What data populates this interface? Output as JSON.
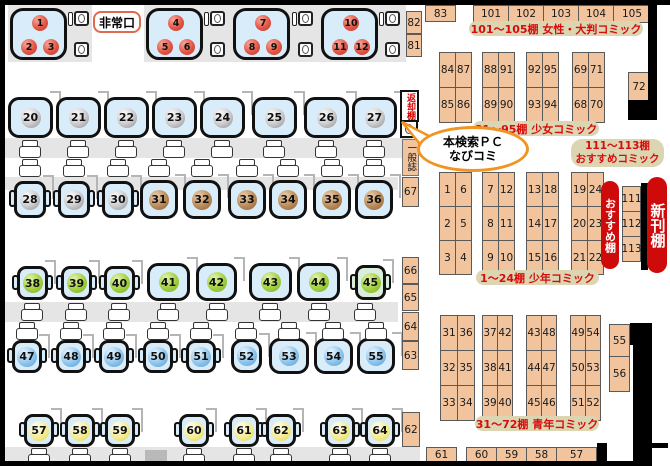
{
  "labels": {
    "exit": "非常口",
    "callout_line1": "本検索ＰＣ",
    "callout_line2": "なびコミ",
    "return_shelf": "返却棚",
    "general_magazines": "一般誌",
    "recommend_shelf": "おすすめ棚",
    "new_arrivals_shelf": "新刊棚"
  },
  "section_labels": {
    "womens": "101～105棚 女性・大判コミック",
    "shojo": "81～95棚 少女コミック",
    "recommend_line1": "111～113棚",
    "recommend_line2": "おすすめコミック",
    "shonen": "1～24棚 少年コミック",
    "seinen": "31～72棚 青年コミック"
  },
  "colors": {
    "room_fill": "#d9ecfa",
    "room45_fill": "#d9eedd",
    "shelf_fill": "#f2c49e",
    "label_text_red": "#d80c0c",
    "label_pill_bg": "#dbd5b2",
    "recommend_pill_bg": "#cf0a0a",
    "exit_border": "#e06a50",
    "callout_border": "#f29422",
    "desk_band": "#e5e5e5",
    "wall": "#000000",
    "seat_red": "#e25545",
    "seat_grey": "#bfbfbf",
    "seat_brown": "#b98a58",
    "seat_green": "#a2cf3f",
    "seat_blue": "#8ec4ec",
    "seat_yellow": "#f3ea8c"
  },
  "map": {
    "group_rooms": [
      {
        "seats": [
          "1",
          "2",
          "3"
        ],
        "x": 10,
        "y": 8
      },
      {
        "seats": [
          "4",
          "5",
          "6"
        ],
        "x": 146,
        "y": 8
      },
      {
        "seats": [
          "7",
          "8",
          "9"
        ],
        "x": 233,
        "y": 8
      },
      {
        "seats": [
          "10",
          "11",
          "12"
        ],
        "x": 321,
        "y": 8
      }
    ],
    "fixtures": [
      [
        68,
        11
      ],
      [
        204,
        11
      ],
      [
        292,
        11
      ],
      [
        379,
        11
      ]
    ],
    "rooms": [
      {
        "n": "20",
        "x": 8,
        "y": 97,
        "w": 45,
        "h": 41,
        "s": "box",
        "c": "grey"
      },
      {
        "n": "21",
        "x": 56,
        "y": 97,
        "w": 45,
        "h": 41,
        "s": "box",
        "c": "grey"
      },
      {
        "n": "22",
        "x": 104,
        "y": 97,
        "w": 45,
        "h": 41,
        "s": "box",
        "c": "grey"
      },
      {
        "n": "23",
        "x": 152,
        "y": 97,
        "w": 45,
        "h": 41,
        "s": "box",
        "c": "grey"
      },
      {
        "n": "24",
        "x": 200,
        "y": 97,
        "w": 45,
        "h": 41,
        "s": "box",
        "c": "grey"
      },
      {
        "n": "25",
        "x": 252,
        "y": 97,
        "w": 45,
        "h": 41,
        "s": "box",
        "c": "grey"
      },
      {
        "n": "26",
        "x": 304,
        "y": 97,
        "w": 45,
        "h": 41,
        "s": "box",
        "c": "grey"
      },
      {
        "n": "27",
        "x": 352,
        "y": 97,
        "w": 45,
        "h": 41,
        "s": "box",
        "c": "grey"
      },
      {
        "n": "28",
        "x": 14,
        "y": 181,
        "w": 32,
        "h": 37,
        "s": "chair",
        "c": "grey"
      },
      {
        "n": "29",
        "x": 58,
        "y": 181,
        "w": 32,
        "h": 37,
        "s": "chair",
        "c": "grey"
      },
      {
        "n": "30",
        "x": 102,
        "y": 181,
        "w": 32,
        "h": 37,
        "s": "chair",
        "c": "grey"
      },
      {
        "n": "31",
        "x": 140,
        "y": 180,
        "w": 38,
        "h": 39,
        "s": "box",
        "c": "brown"
      },
      {
        "n": "32",
        "x": 183,
        "y": 180,
        "w": 38,
        "h": 39,
        "s": "box",
        "c": "brown"
      },
      {
        "n": "33",
        "x": 228,
        "y": 180,
        "w": 38,
        "h": 39,
        "s": "box",
        "c": "brown"
      },
      {
        "n": "34",
        "x": 269,
        "y": 180,
        "w": 38,
        "h": 39,
        "s": "box",
        "c": "brown"
      },
      {
        "n": "35",
        "x": 313,
        "y": 180,
        "w": 38,
        "h": 39,
        "s": "box",
        "c": "brown"
      },
      {
        "n": "36",
        "x": 355,
        "y": 180,
        "w": 38,
        "h": 39,
        "s": "box",
        "c": "brown"
      },
      {
        "n": "38",
        "x": 17,
        "y": 266,
        "w": 31,
        "h": 34,
        "s": "chair",
        "c": "green"
      },
      {
        "n": "39",
        "x": 61,
        "y": 266,
        "w": 31,
        "h": 34,
        "s": "chair",
        "c": "green"
      },
      {
        "n": "40",
        "x": 104,
        "y": 266,
        "w": 31,
        "h": 34,
        "s": "chair",
        "c": "green"
      },
      {
        "n": "41",
        "x": 147,
        "y": 263,
        "w": 43,
        "h": 38,
        "s": "box",
        "c": "green"
      },
      {
        "n": "42",
        "x": 196,
        "y": 263,
        "w": 41,
        "h": 38,
        "s": "box",
        "c": "green"
      },
      {
        "n": "43",
        "x": 249,
        "y": 263,
        "w": 43,
        "h": 38,
        "s": "box",
        "c": "green"
      },
      {
        "n": "44",
        "x": 297,
        "y": 263,
        "w": 43,
        "h": 38,
        "s": "box",
        "c": "green"
      },
      {
        "n": "45",
        "x": 355,
        "y": 265,
        "w": 31,
        "h": 35,
        "s": "chair",
        "c": "green",
        "fill": "#d9eedd"
      },
      {
        "n": "47",
        "x": 12,
        "y": 340,
        "w": 30,
        "h": 33,
        "s": "chair",
        "c": "blue"
      },
      {
        "n": "48",
        "x": 56,
        "y": 340,
        "w": 30,
        "h": 33,
        "s": "chair",
        "c": "blue"
      },
      {
        "n": "49",
        "x": 99,
        "y": 340,
        "w": 30,
        "h": 33,
        "s": "chair",
        "c": "blue"
      },
      {
        "n": "50",
        "x": 143,
        "y": 340,
        "w": 30,
        "h": 33,
        "s": "chair",
        "c": "blue"
      },
      {
        "n": "51",
        "x": 186,
        "y": 340,
        "w": 30,
        "h": 33,
        "s": "chair",
        "c": "blue"
      },
      {
        "n": "52",
        "x": 231,
        "y": 339,
        "w": 31,
        "h": 34,
        "s": "box",
        "c": "blue"
      },
      {
        "n": "53",
        "x": 269,
        "y": 338,
        "w": 40,
        "h": 36,
        "s": "box",
        "c": "blue"
      },
      {
        "n": "54",
        "x": 314,
        "y": 338,
        "w": 39,
        "h": 36,
        "s": "box",
        "c": "blue"
      },
      {
        "n": "55",
        "x": 357,
        "y": 338,
        "w": 38,
        "h": 36,
        "s": "box",
        "c": "blue"
      },
      {
        "n": "57",
        "x": 24,
        "y": 414,
        "w": 30,
        "h": 33,
        "s": "chair",
        "c": "yellow"
      },
      {
        "n": "58",
        "x": 65,
        "y": 414,
        "w": 30,
        "h": 33,
        "s": "chair",
        "c": "yellow"
      },
      {
        "n": "59",
        "x": 105,
        "y": 414,
        "w": 30,
        "h": 33,
        "s": "chair",
        "c": "yellow"
      },
      {
        "n": "60",
        "x": 179,
        "y": 414,
        "w": 30,
        "h": 33,
        "s": "chair",
        "c": "yellow"
      },
      {
        "n": "61",
        "x": 229,
        "y": 414,
        "w": 30,
        "h": 33,
        "s": "chair",
        "c": "yellow"
      },
      {
        "n": "62",
        "x": 266,
        "y": 414,
        "w": 30,
        "h": 33,
        "s": "chair",
        "c": "yellow"
      },
      {
        "n": "63",
        "x": 325,
        "y": 414,
        "w": 30,
        "h": 33,
        "s": "chair",
        "c": "yellow"
      },
      {
        "n": "64",
        "x": 365,
        "y": 414,
        "w": 30,
        "h": 33,
        "s": "chair",
        "c": "yellow"
      }
    ],
    "chair_rows": [
      {
        "y": 140,
        "x": [
          19,
          67,
          115,
          163,
          211,
          263,
          315,
          363
        ]
      },
      {
        "y": 159,
        "x": [
          19,
          63,
          107,
          148,
          191,
          236,
          277,
          321,
          363
        ]
      },
      {
        "y": 303,
        "x": [
          21,
          65,
          108,
          157,
          206,
          259,
          308,
          354
        ]
      },
      {
        "y": 322,
        "x": [
          16,
          60,
          103,
          147,
          190,
          235,
          278,
          322,
          365
        ]
      },
      {
        "y": 448,
        "x": [
          28,
          69,
          109,
          183,
          233,
          270,
          329,
          369
        ]
      }
    ],
    "shelf_singles": [
      {
        "label": "83",
        "x": 425,
        "y": 5,
        "w": 31,
        "h": 17
      },
      {
        "label": "101",
        "x": 473,
        "y": 5,
        "w": 36,
        "h": 18
      },
      {
        "label": "102",
        "x": 508,
        "y": 5,
        "w": 36,
        "h": 18
      },
      {
        "label": "103",
        "x": 543,
        "y": 5,
        "w": 36,
        "h": 18
      },
      {
        "label": "104",
        "x": 578,
        "y": 5,
        "w": 36,
        "h": 18
      },
      {
        "label": "105",
        "x": 613,
        "y": 5,
        "w": 38,
        "h": 18
      },
      {
        "label": "82",
        "x": 406,
        "y": 11,
        "w": 16,
        "h": 23
      },
      {
        "label": "81",
        "x": 406,
        "y": 34,
        "w": 16,
        "h": 23
      },
      {
        "label": "72",
        "x": 628,
        "y": 72,
        "w": 22,
        "h": 29
      },
      {
        "label": "67",
        "x": 402,
        "y": 177,
        "w": 17,
        "h": 30
      },
      {
        "label": "66",
        "x": 402,
        "y": 257,
        "w": 17,
        "h": 27
      },
      {
        "label": "65",
        "x": 402,
        "y": 284,
        "w": 17,
        "h": 27
      },
      {
        "label": "64",
        "x": 402,
        "y": 312,
        "w": 17,
        "h": 29
      },
      {
        "label": "63",
        "x": 402,
        "y": 341,
        "w": 17,
        "h": 29
      },
      {
        "label": "62",
        "x": 402,
        "y": 412,
        "w": 18,
        "h": 35
      },
      {
        "label": "111",
        "x": 622,
        "y": 186,
        "w": 19,
        "h": 26
      },
      {
        "label": "112",
        "x": 622,
        "y": 211,
        "w": 19,
        "h": 26
      },
      {
        "label": "113",
        "x": 622,
        "y": 236,
        "w": 19,
        "h": 26
      },
      {
        "label": "55",
        "x": 609,
        "y": 324,
        "w": 21,
        "h": 33
      },
      {
        "label": "56",
        "x": 609,
        "y": 356,
        "w": 21,
        "h": 36
      },
      {
        "label": "61",
        "x": 426,
        "y": 447,
        "w": 31,
        "h": 15
      },
      {
        "label": "60",
        "x": 466,
        "y": 447,
        "w": 31,
        "h": 15
      },
      {
        "label": "59",
        "x": 496,
        "y": 447,
        "w": 31,
        "h": 15
      },
      {
        "label": "58",
        "x": 526,
        "y": 447,
        "w": 31,
        "h": 15
      },
      {
        "label": "57",
        "x": 556,
        "y": 447,
        "w": 41,
        "h": 15
      }
    ],
    "shelf_groups": [
      {
        "x": 439,
        "y": 52,
        "cw": 16,
        "ch": 35,
        "cells": [
          [
            "84",
            "87"
          ],
          [
            "85",
            "86"
          ]
        ]
      },
      {
        "x": 482,
        "y": 52,
        "cw": 16,
        "ch": 35,
        "cells": [
          [
            "88",
            "91"
          ],
          [
            "89",
            "90"
          ]
        ]
      },
      {
        "x": 526,
        "y": 52,
        "cw": 16,
        "ch": 35,
        "cells": [
          [
            "92",
            "95"
          ],
          [
            "93",
            "94"
          ]
        ]
      },
      {
        "x": 572,
        "y": 52,
        "cw": 16,
        "ch": 35,
        "cells": [
          [
            "69",
            "71"
          ],
          [
            "68",
            "70"
          ]
        ]
      },
      {
        "x": 439,
        "y": 172,
        "cw": 16,
        "ch": 34,
        "cells": [
          [
            "1",
            "6"
          ],
          [
            "2",
            "5"
          ],
          [
            "3",
            "4"
          ]
        ]
      },
      {
        "x": 482,
        "y": 172,
        "cw": 16,
        "ch": 34,
        "cells": [
          [
            "7",
            "12"
          ],
          [
            "8",
            "11"
          ],
          [
            "9",
            "10"
          ]
        ]
      },
      {
        "x": 526,
        "y": 172,
        "cw": 16,
        "ch": 34,
        "cells": [
          [
            "13",
            "18"
          ],
          [
            "14",
            "17"
          ],
          [
            "15",
            "16"
          ]
        ]
      },
      {
        "x": 571,
        "y": 172,
        "cw": 16,
        "ch": 34,
        "cells": [
          [
            "19",
            "24"
          ],
          [
            "20",
            "23"
          ],
          [
            "21",
            "22"
          ]
        ]
      },
      {
        "x": 440,
        "y": 315,
        "cw": 17,
        "ch": 35,
        "cells": [
          [
            "31",
            "36"
          ],
          [
            "32",
            "35"
          ],
          [
            "33",
            "34"
          ]
        ]
      },
      {
        "x": 482,
        "y": 315,
        "cw": 15,
        "ch": 35,
        "cells": [
          [
            "37",
            "42"
          ],
          [
            "38",
            "41"
          ],
          [
            "39",
            "40"
          ]
        ]
      },
      {
        "x": 526,
        "y": 315,
        "cw": 15,
        "ch": 35,
        "cells": [
          [
            "43",
            "48"
          ],
          [
            "44",
            "47"
          ],
          [
            "45",
            "46"
          ]
        ]
      },
      {
        "x": 570,
        "y": 315,
        "cw": 15,
        "ch": 35,
        "cells": [
          [
            "49",
            "54"
          ],
          [
            "50",
            "53"
          ],
          [
            "51",
            "52"
          ]
        ]
      }
    ],
    "bands": [
      [
        8,
        5,
        84,
        57
      ],
      [
        144,
        5,
        86,
        57
      ],
      [
        230,
        5,
        90,
        57
      ],
      [
        318,
        5,
        88,
        57
      ],
      [
        0,
        138,
        412,
        20
      ],
      [
        0,
        177,
        398,
        13
      ],
      [
        0,
        302,
        398,
        20
      ],
      [
        0,
        447,
        420,
        15
      ]
    ],
    "grey_blocks": [
      [
        145,
        450,
        22,
        13
      ]
    ],
    "walls": [
      [
        0,
        0,
        670,
        5
      ],
      [
        0,
        0,
        5,
        466
      ],
      [
        0,
        461,
        652,
        5
      ],
      [
        648,
        0,
        9,
        120
      ],
      [
        628,
        100,
        29,
        20
      ],
      [
        641,
        183,
        7,
        87
      ],
      [
        630,
        323,
        22,
        22
      ],
      [
        633,
        343,
        19,
        123
      ],
      [
        633,
        443,
        35,
        5
      ],
      [
        597,
        443,
        10,
        20
      ]
    ]
  }
}
